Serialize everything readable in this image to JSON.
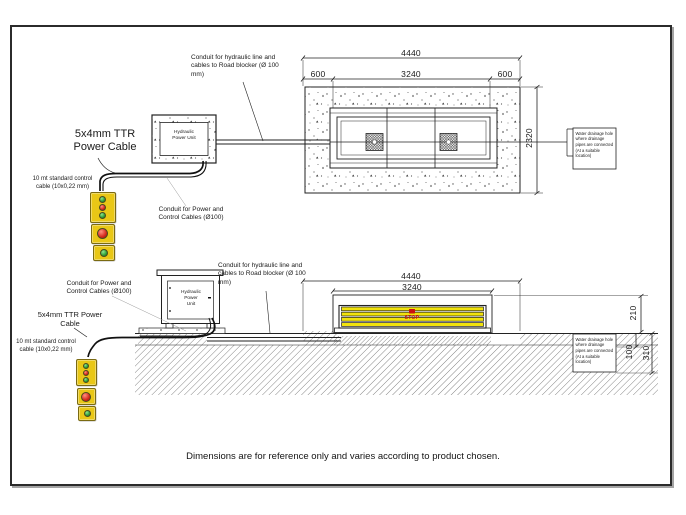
{
  "sheet": {
    "footer": "Dimensions are for reference only and varies according to product chosen."
  },
  "labels": {
    "conduit_hydraulic": "Conduit for hydraulic line and cables to Road blocker (Ø 100 mm)",
    "conduit_power": "Conduit for Power and Control Cables (Ø100)",
    "power_cable": "5x4mm TTR Power Cable",
    "control_cable": "10 mt standard control cable (10x0,22 mm)",
    "hpu": "Hydraulic Power Unit",
    "drainage_note": "Water drainage hole where drainage pipes are connected (At a suitable location)",
    "stop": "STOP"
  },
  "dims": {
    "plan": {
      "overall": "4440",
      "left_margin": "600",
      "pit_width": "3240",
      "right_margin": "600",
      "depth": "2320"
    },
    "section": {
      "overall": "4440",
      "blocker_width": "3240",
      "raise_height": "210",
      "asphalt_depth": "100",
      "pit_depth": "310"
    }
  },
  "colors": {
    "control_box_yellow": "#e9c716",
    "button_red": "#d3281c",
    "button_green": "#2f9e38",
    "blocker_yellow": "#f2e30c",
    "stop_red": "#cc1111",
    "line": "#222222"
  }
}
